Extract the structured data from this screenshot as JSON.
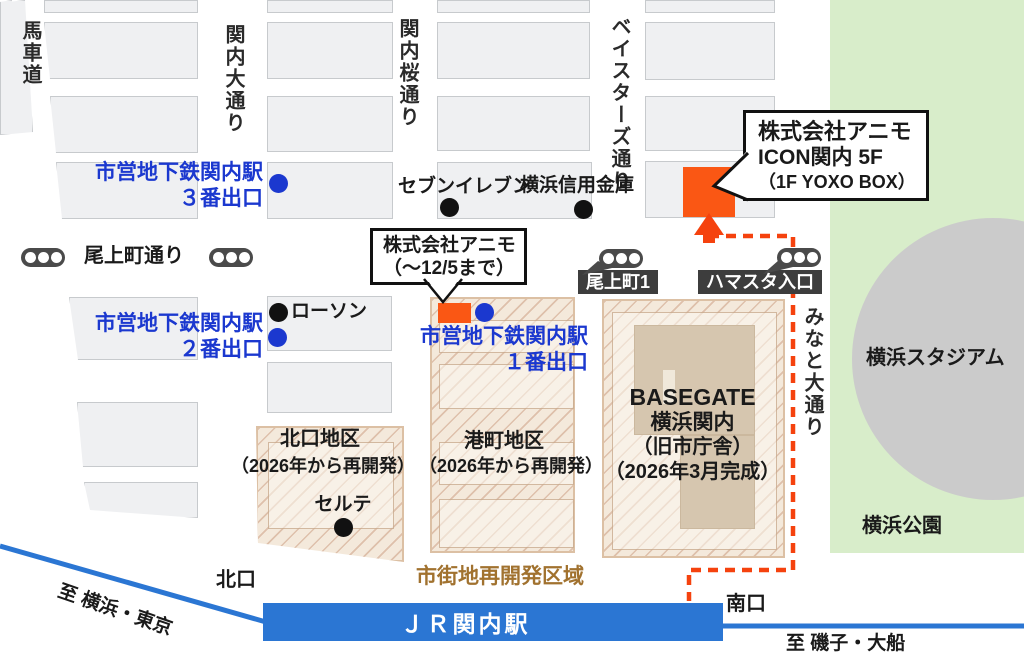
{
  "colors": {
    "blue": "#1b38cf",
    "orange": "#fa5714",
    "route": "#f5420e",
    "rail": "#2b76d3",
    "green": "#d8edca",
    "stadium": "#cbcbcb",
    "zonebg": "#f4e9db",
    "zoneline": "#dcc0a4",
    "brown": "#a1722f",
    "darklabel": "#3d3d3d",
    "bld": "#eff0f2",
    "bldborder": "#c7cacd"
  },
  "streets": {
    "bashamichi": "馬車道",
    "kannai_odori": "関内大通り",
    "kannai_sakura": "関内桜通り",
    "baystars": "ベイスターズ通り",
    "onoe_dori": "尾上町通り",
    "minato_odori": "みなと大通り"
  },
  "stations": {
    "subway_name": "市営地下鉄関内駅",
    "exit3": "３番出口",
    "exit2": "２番出口",
    "exit1": "１番出口",
    "jr": "ＪＲ関内駅"
  },
  "landmarks": {
    "seven_eleven": "セブンイレブン",
    "yokohama_shinkin": "横浜信用金庫",
    "lawson": "ローソン",
    "celte": "セルテ",
    "stadium": "横浜スタジアム",
    "park": "横浜公園"
  },
  "callouts": {
    "new_office": {
      "line1": "株式会社アニモ",
      "line2": "ICON関内 5F",
      "line3": "（1F YOXO BOX）"
    },
    "old_office": {
      "line1": "株式会社アニモ",
      "line2": "（～12/5まで）"
    }
  },
  "signs": {
    "onoecho1": "尾上町1",
    "hamasuta": "ハマスタ入口"
  },
  "districts": {
    "north_name": "北口地区",
    "north_note": "（2026年から再開発）",
    "minatocho_name": "港町地区",
    "minatocho_note": "（2026年から再開発）",
    "basegate1": "BASEGATE",
    "basegate2": "横浜関内",
    "basegate3": "（旧市庁舎）",
    "basegate4": "（2026年3月完成）",
    "redevelop_label": "市街地再開発区域"
  },
  "exits": {
    "north": "北口",
    "south": "南口"
  },
  "directions": {
    "to_yokohama": "至 横浜・東京",
    "to_isogo": "至 磯子・大船"
  }
}
